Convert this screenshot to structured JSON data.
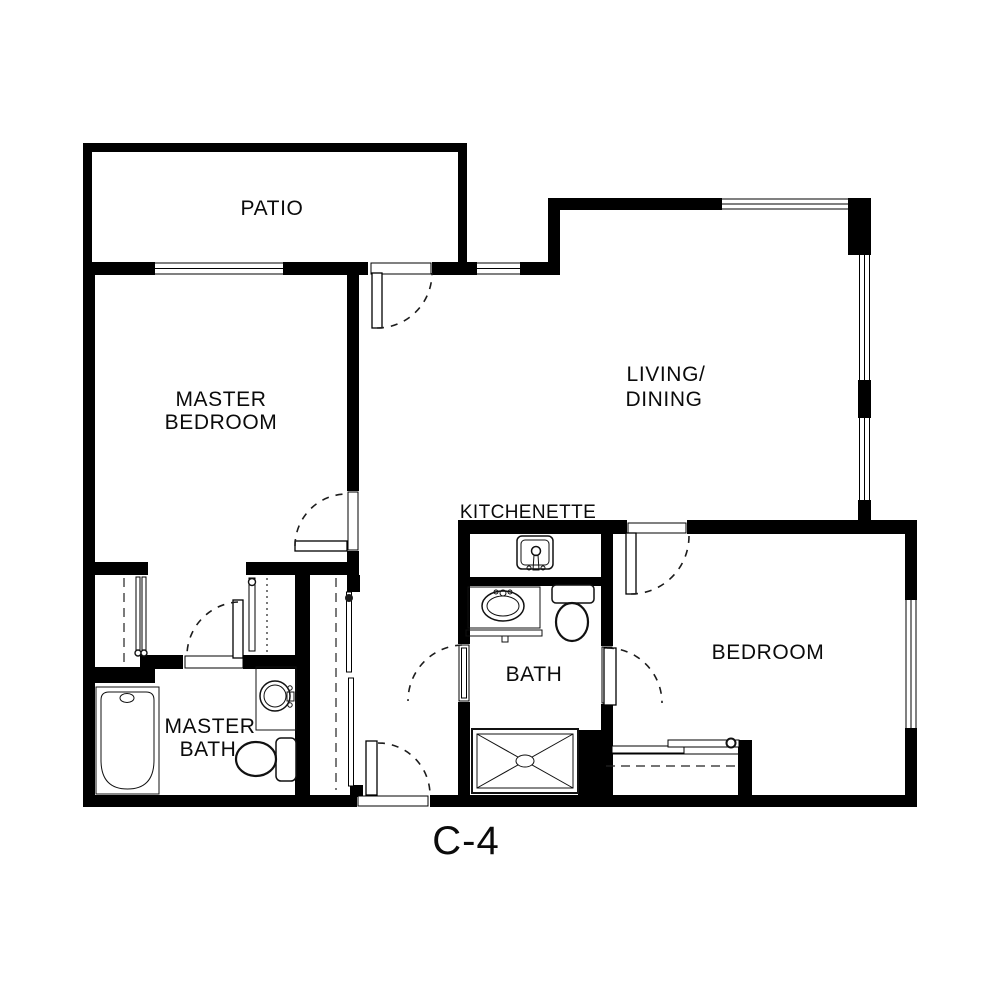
{
  "plan": {
    "name": "C-4",
    "type": "floor-plan",
    "colors": {
      "wall": "#000000",
      "floor": "#ffffff",
      "swing_line": "#1c1c1c"
    },
    "rooms": {
      "patio": {
        "label": "PATIO"
      },
      "master_bedroom": {
        "line1": "MASTER",
        "line2": "BEDROOM"
      },
      "living_dining": {
        "line1": "LIVING/",
        "line2": "DINING"
      },
      "kitchenette": {
        "label": "KITCHENETTE"
      },
      "bath": {
        "label": "BATH"
      },
      "bedroom": {
        "label": "BEDROOM"
      },
      "master_bath": {
        "line1": "MASTER",
        "line2": "BATH"
      }
    },
    "fixtures": [
      "bathtub",
      "master-bath-sink",
      "master-bath-toilet",
      "kitchenette-sink",
      "bath-vanity-sink",
      "bath-toilet",
      "shower"
    ],
    "doors": 7,
    "windows": 6,
    "closets": 4
  }
}
